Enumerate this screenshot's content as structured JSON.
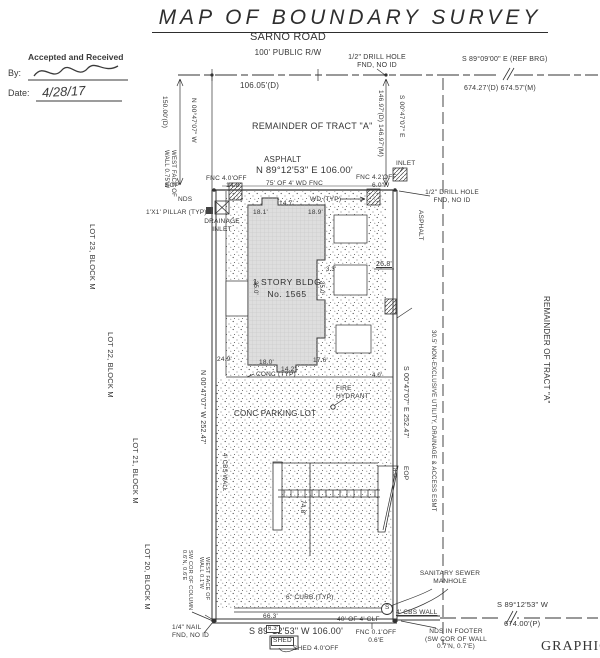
{
  "page": {
    "title": "MAP OF BOUNDARY SURVEY"
  },
  "stamp": {
    "header": "Accepted and Received",
    "by_label": "By:",
    "date_label": "Date:",
    "date_value": "4/28/17"
  },
  "building": {
    "line1": "1 STORY BLDG",
    "line2": "No. 1565"
  },
  "colors": {
    "ink": "#333333",
    "building_fill": "#dedede",
    "paper": "#ffffff"
  },
  "annotations": [
    {
      "id": "road-name",
      "t": "SARNO ROAD",
      "x": 228,
      "y": 31,
      "fs": 11,
      "w": 120,
      "align": "center"
    },
    {
      "id": "road-right-of-way",
      "t": "100' PUBLIC R/W",
      "x": 228,
      "y": 48,
      "fs": 8,
      "w": 120,
      "align": "center"
    },
    {
      "id": "dim-106-05",
      "t": "106.05'(D)",
      "x": 240,
      "y": 81,
      "fs": 8
    },
    {
      "id": "drill-hole-top",
      "t": "1/2\" DRILL HOLE\nFND, NO ID",
      "x": 345,
      "y": 54,
      "fs": 7,
      "w": 64,
      "align": "center"
    },
    {
      "id": "ref-bearing",
      "t": "S 89°09'00\" E (REF BRG)",
      "x": 462,
      "y": 56,
      "fs": 7
    },
    {
      "id": "dim-674-27",
      "t": "674.27'(D) 674.57'(M)",
      "x": 464,
      "y": 85,
      "fs": 7
    },
    {
      "id": "remainder-tract-a",
      "t": "REMAINDER OF TRACT \"A\"",
      "x": 252,
      "y": 121,
      "fs": 9
    },
    {
      "id": "asphalt-top",
      "t": "ASPHALT",
      "x": 264,
      "y": 155,
      "fs": 8
    },
    {
      "id": "bearing-north",
      "t": "N 89°12'53\" E 106.00'",
      "x": 256,
      "y": 165,
      "fs": 9.5
    },
    {
      "id": "fnc-4-0-off",
      "t": "FNC 4.0'OFF",
      "x": 206,
      "y": 175,
      "fs": 6.5
    },
    {
      "id": "dim-14-8",
      "t": "14.8'",
      "x": 226,
      "y": 182,
      "fs": 6.5
    },
    {
      "id": "fence-75",
      "t": "75' OF 4' WD FNC",
      "x": 266,
      "y": 180,
      "fs": 6.5
    },
    {
      "id": "fnc-4-2-off",
      "t": "FNC 4.2'OFF",
      "x": 356,
      "y": 174,
      "fs": 6.5
    },
    {
      "id": "dim-6-0w",
      "t": "6.0'W",
      "x": 372,
      "y": 182,
      "fs": 6.5
    },
    {
      "id": "eop-top",
      "t": "EOP",
      "x": 165,
      "y": 182,
      "fs": 6.5
    },
    {
      "id": "inlet-top",
      "t": "INLET",
      "x": 396,
      "y": 160,
      "fs": 6.5
    },
    {
      "id": "nds-top",
      "t": "NDS",
      "x": 178,
      "y": 196,
      "fs": 6.5
    },
    {
      "id": "drill-hole-right",
      "t": "1/2\" DRILL HOLE\nFND, NO ID",
      "x": 423,
      "y": 189,
      "fs": 6.5,
      "w": 58,
      "align": "center"
    },
    {
      "id": "pillar",
      "t": "1'X1' PILLAR (TYP)",
      "x": 146,
      "y": 209,
      "fs": 6.5
    },
    {
      "id": "drainage-inlet-left",
      "t": "DRAINAGE\nINLET",
      "x": 204,
      "y": 218,
      "fs": 6.5,
      "w": 36,
      "align": "center"
    },
    {
      "id": "wd-typ",
      "t": "WD (TYP)",
      "x": 310,
      "y": 196,
      "fs": 6.5
    },
    {
      "id": "dim-18-1",
      "t": "18.1'",
      "x": 253,
      "y": 209,
      "fs": 6.5
    },
    {
      "id": "dim-14-7",
      "t": "14.7'",
      "x": 279,
      "y": 200,
      "fs": 6.5
    },
    {
      "id": "dim-18-9",
      "t": "18.9'",
      "x": 308,
      "y": 209,
      "fs": 6.5
    },
    {
      "id": "dim-26-8",
      "t": "26.8'",
      "x": 376,
      "y": 261,
      "fs": 7,
      "u": true
    },
    {
      "id": "dim-3-3",
      "t": "3.3'",
      "x": 326,
      "y": 267,
      "fs": 6
    },
    {
      "id": "dim-35-0-left",
      "t": "35.0'",
      "x": 258,
      "y": 281,
      "fs": 6,
      "rot": true
    },
    {
      "id": "dim-35-0-right",
      "t": "35.0'",
      "x": 324,
      "y": 281,
      "fs": 6,
      "rot": true
    },
    {
      "id": "dim-24-9",
      "t": "24.9'",
      "x": 217,
      "y": 356,
      "fs": 6.5
    },
    {
      "id": "dim-18-0",
      "t": "18.0'",
      "x": 259,
      "y": 359,
      "fs": 6.5
    },
    {
      "id": "dim-14-2",
      "t": "14.2'",
      "x": 281,
      "y": 366,
      "fs": 6.5
    },
    {
      "id": "dim-17-6",
      "t": "17.6'",
      "x": 313,
      "y": 357,
      "fs": 6.5
    },
    {
      "id": "conc-typ",
      "t": "CONC (TYP)",
      "x": 256,
      "y": 371,
      "fs": 6.5
    },
    {
      "id": "dim-4-0",
      "t": "4.0'",
      "x": 372,
      "y": 373,
      "fs": 6
    },
    {
      "id": "fire-hydrant",
      "t": "FIRE\nHYDRANT",
      "x": 336,
      "y": 385,
      "fs": 6.5
    },
    {
      "id": "conc-parking-lot",
      "t": "CONC PARKING LOT",
      "x": 234,
      "y": 409,
      "fs": 8
    },
    {
      "id": "dim-74-8",
      "t": "74.8'",
      "x": 306,
      "y": 500,
      "fs": 6.5,
      "rot": true
    },
    {
      "id": "dim-8-0",
      "t": "8.0'",
      "x": 397,
      "y": 468,
      "fs": 6,
      "rot": true
    },
    {
      "id": "curb-6in",
      "t": "6\" CURB (TYP)",
      "x": 286,
      "y": 594,
      "fs": 6.5
    },
    {
      "id": "dim-66-3",
      "t": "66.3'",
      "x": 263,
      "y": 613,
      "fs": 6.5
    },
    {
      "id": "bearing-south",
      "t": "S 89°12'53\" W 106.00'",
      "x": 249,
      "y": 626,
      "fs": 9
    },
    {
      "id": "clf-40",
      "t": "40' OF 4' CLF",
      "x": 337,
      "y": 616,
      "fs": 6.5
    },
    {
      "id": "fnc-bottom",
      "t": "FNC 0.1'OFF\n0.6'E",
      "x": 355,
      "y": 629,
      "fs": 6.5,
      "w": 42,
      "align": "center"
    },
    {
      "id": "nail-found",
      "t": "1/4\" NAIL\nFND, NO ID",
      "x": 172,
      "y": 624,
      "fs": 6.5
    },
    {
      "id": "shed",
      "t": "SHED",
      "x": 271,
      "y": 637,
      "fs": 6.5,
      "box": true
    },
    {
      "id": "dim-6-3",
      "t": "6.3'",
      "x": 266,
      "y": 625,
      "fs": 6,
      "box": true
    },
    {
      "id": "shed-off",
      "t": "SHED 4.0'OFF",
      "x": 293,
      "y": 645,
      "fs": 6.5
    },
    {
      "id": "sanitary-manhole",
      "t": "SANITARY SEWER\nMANHOLE",
      "x": 414,
      "y": 570,
      "fs": 6.5,
      "w": 72,
      "align": "center"
    },
    {
      "id": "manhole-s",
      "t": "S",
      "x": 385,
      "y": 604,
      "fs": 6.5
    },
    {
      "id": "cbs-wall-bottom",
      "t": "4' CBS WALL",
      "x": 396,
      "y": 609,
      "fs": 6.5,
      "u": true
    },
    {
      "id": "nds-footer",
      "t": "NDS IN FOOTER\n(SW COR OF WALL\n0.7'N, 0.7'E)",
      "x": 416,
      "y": 628,
      "fs": 6.5,
      "w": 80,
      "align": "center"
    },
    {
      "id": "bearing-se",
      "t": "S 89°12'53\" W",
      "x": 497,
      "y": 601,
      "fs": 7.5
    },
    {
      "id": "dim-674-00",
      "t": "674.00'(P)",
      "x": 504,
      "y": 620,
      "fs": 7.5
    },
    {
      "id": "graphic-corner",
      "t": "GRAPHIC",
      "x": 541,
      "y": 639,
      "fs": 14,
      "serif": true
    },
    {
      "id": "dim-150-00",
      "t": "150.00'(D)",
      "x": 168,
      "y": 96,
      "fs": 6.5,
      "rot": true
    },
    {
      "id": "bearing-west-top",
      "t": "N 00°47'07\" W",
      "x": 197,
      "y": 98,
      "fs": 6.5,
      "rot": true
    },
    {
      "id": "dim-146-97",
      "t": "146.97'(D) 146.97'(M)",
      "x": 384,
      "y": 90,
      "fs": 6.5,
      "rot": true
    },
    {
      "id": "bearing-east-top",
      "t": "S 00°47'07\" E",
      "x": 405,
      "y": 95,
      "fs": 6.5,
      "rot": true
    },
    {
      "id": "west-face-wall-top",
      "t": "WEST FACE OF\nWALL 0.75'W",
      "x": 176,
      "y": 150,
      "fs": 6,
      "rot": true
    },
    {
      "id": "lot-23",
      "t": "LOT 23, BLOCK M",
      "x": 96,
      "y": 224,
      "fs": 7.5,
      "rot": true
    },
    {
      "id": "lot-22",
      "t": "LOT 22, BLOCK M",
      "x": 114,
      "y": 332,
      "fs": 7.5,
      "rot": true
    },
    {
      "id": "lot-21",
      "t": "LOT 21, BLOCK M",
      "x": 139,
      "y": 438,
      "fs": 7.5,
      "rot": true
    },
    {
      "id": "lot-20",
      "t": "LOT 20, BLOCK M",
      "x": 151,
      "y": 544,
      "fs": 7.5,
      "rot": true
    },
    {
      "id": "bearing-west",
      "t": "N 00°47'07\" W 252.47'",
      "x": 206,
      "y": 370,
      "fs": 7,
      "rot": true
    },
    {
      "id": "cbs-wall-west",
      "t": "4' CBS WALL",
      "x": 227,
      "y": 453,
      "fs": 6,
      "rot": true
    },
    {
      "id": "bearing-east",
      "t": "S 00°47'07\" E 252.47'",
      "x": 409,
      "y": 366,
      "fs": 7,
      "rot": true
    },
    {
      "id": "eop-right",
      "t": "EOP",
      "x": 409,
      "y": 466,
      "fs": 6.5,
      "rot": true
    },
    {
      "id": "easement",
      "t": "30.5' NON-EXCLUSIVE UTILITY, DRAINAGE & ACCESS ESMT",
      "x": 436,
      "y": 330,
      "fs": 6,
      "rot": true
    },
    {
      "id": "asphalt-right",
      "t": "ASPHALT",
      "x": 424,
      "y": 210,
      "fs": 6.5,
      "rot": true
    },
    {
      "id": "remainder-tract-a-right",
      "t": "REMAINDER OF TRACT \"A\"",
      "x": 551,
      "y": 296,
      "fs": 8,
      "rot": true
    },
    {
      "id": "column-offset",
      "t": "SW COR OF COLUMN\n0.6'N, 0.6'E",
      "x": 193,
      "y": 550,
      "fs": 5.5,
      "rot": true
    },
    {
      "id": "west-face-wall-bottom",
      "t": "WEST FACE OF\nWALL 0.1'W",
      "x": 210,
      "y": 557,
      "fs": 5.5,
      "rot": true
    }
  ]
}
